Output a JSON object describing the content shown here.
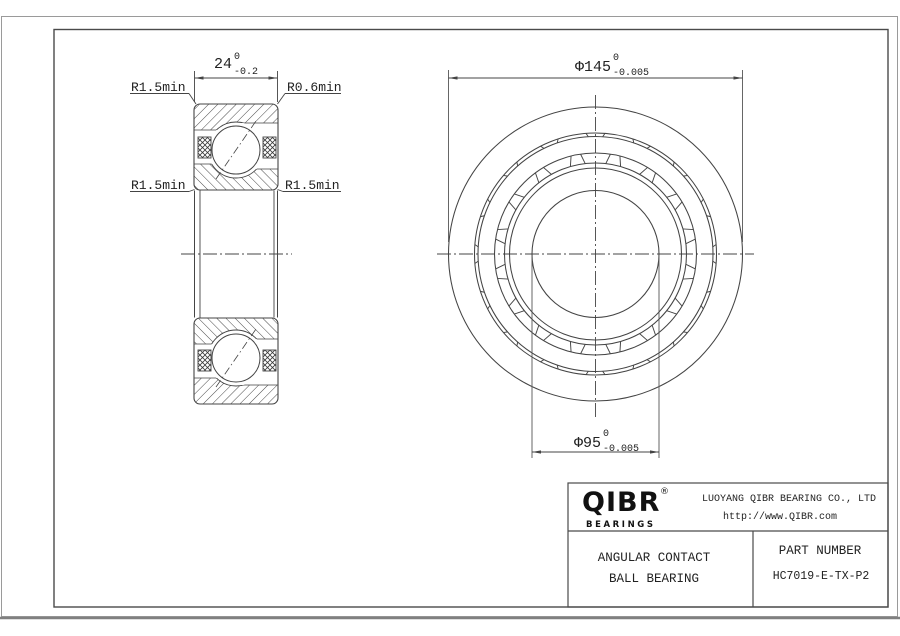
{
  "dimensions": {
    "width": {
      "value": "24",
      "tol_upper": "0",
      "tol_lower": "-0.2"
    },
    "outer_diameter": {
      "value": "Φ145",
      "tol_upper": "0",
      "tol_lower": "-0.005"
    },
    "bore_diameter": {
      "value": "Φ95",
      "tol_upper": "0",
      "tol_lower": "-0.005"
    }
  },
  "labels": {
    "top_left": "R1.5min",
    "top_right": "R0.6min",
    "mid_left": "R1.5min",
    "mid_right": "R1.5min"
  },
  "title_block": {
    "logo_text": "QIBR",
    "registered_mark": "®",
    "logo_subtext": "BEARINGS",
    "company_name": "LUOYANG QIBR BEARING CO., LTD",
    "website": "http://www.QIBR.com",
    "product_type_line1": "ANGULAR CONTACT",
    "product_type_line2": "BALL BEARING",
    "part_number_label": "PART NUMBER",
    "part_number": "HC7019-E-TX-P2"
  },
  "front_view": {
    "ball_pocket_count": 16
  },
  "colors": {
    "line": "#404040",
    "frame": "#999999",
    "text": "#222222",
    "background": "#ffffff"
  }
}
